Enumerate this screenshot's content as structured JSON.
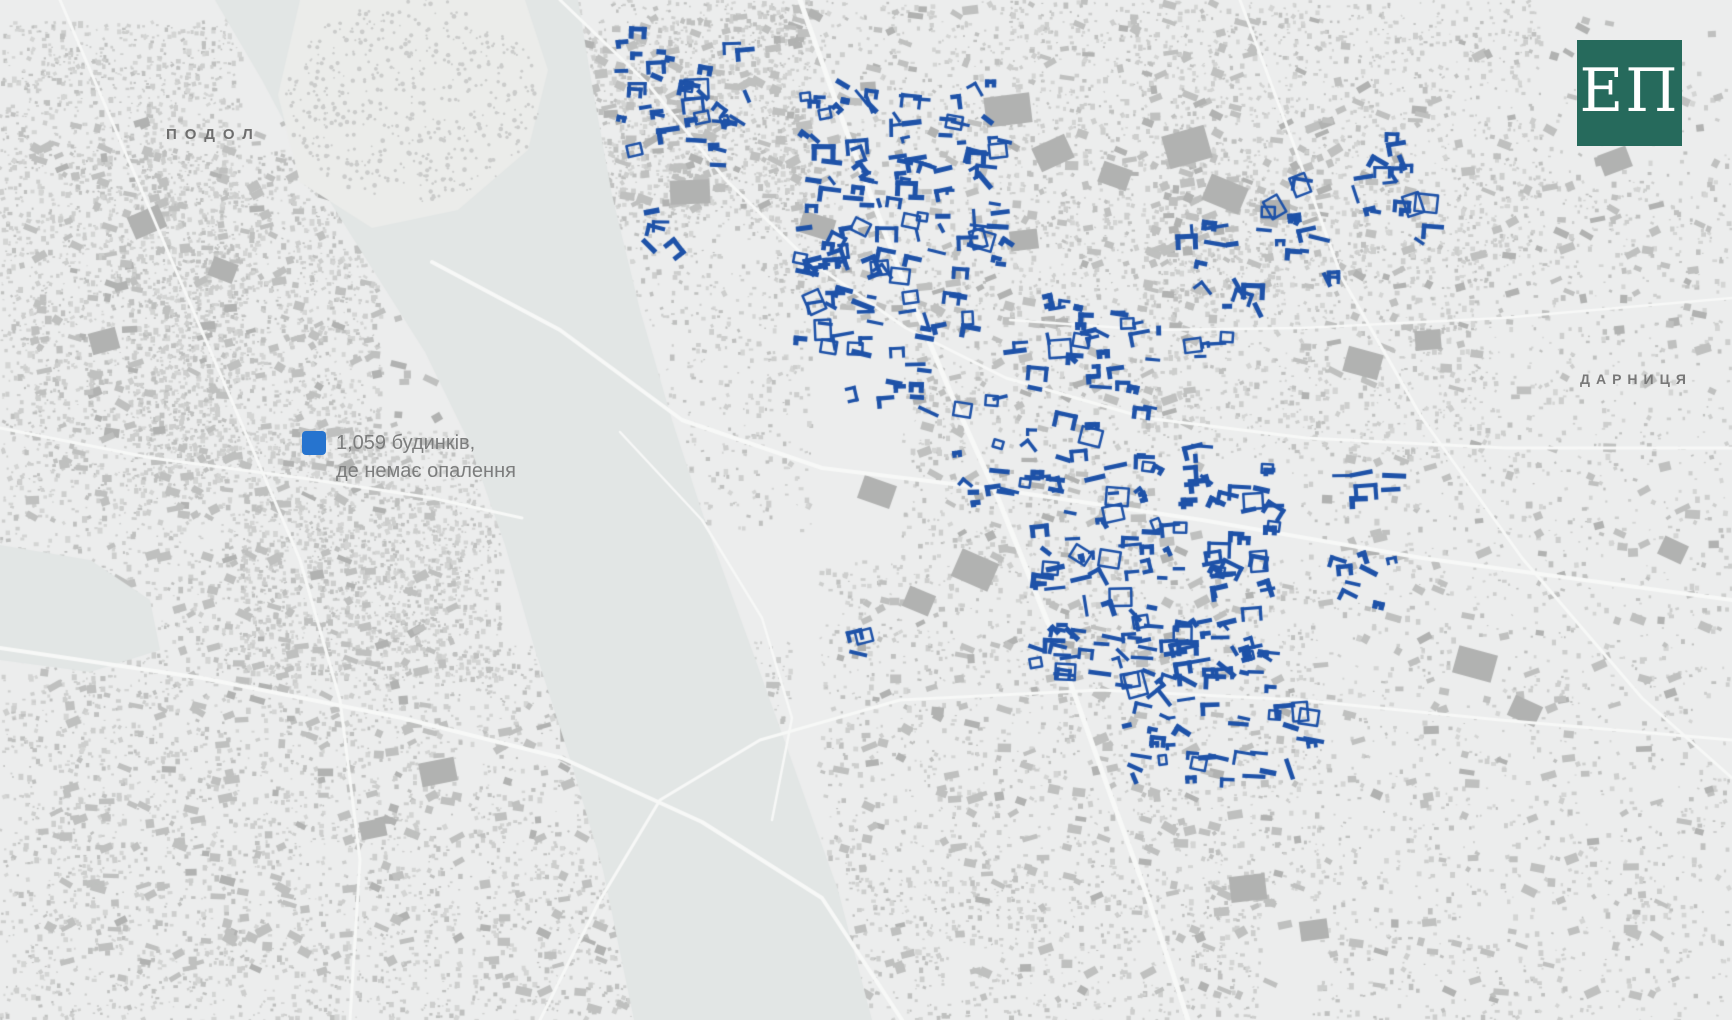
{
  "labels": {
    "podol": "ПОДОЛ",
    "darnytsia": "ДАРНИЦЯ"
  },
  "legend": {
    "line1": "1,059 будинків,",
    "line2": "де немає опалення",
    "swatch_color": "#2674cf",
    "text_color": "#7c7d7d"
  },
  "logo": {
    "text": "ЕП",
    "bg_color": "#266a5c",
    "text_color": "#ffffff"
  },
  "colors": {
    "land": "#eceded",
    "island_land": "#ebecea",
    "water": "#e2e6e5",
    "road": "#f7f8f7",
    "building_light": "#cdcecd",
    "building_mid": "#bfc0bf",
    "building_dark": "#b1b2b1",
    "tree": "#cbcccb",
    "highlight_blue": "#1e52a8"
  },
  "map_render": {
    "seed": 1337,
    "speckle_regions": [
      {
        "x": 0,
        "y": 20,
        "w": 240,
        "h": 480,
        "n": 2300
      },
      {
        "x": 130,
        "y": 150,
        "w": 250,
        "h": 330,
        "n": 1700
      },
      {
        "x": 240,
        "y": 430,
        "w": 260,
        "h": 250,
        "n": 1300
      },
      {
        "x": 0,
        "y": 500,
        "w": 460,
        "h": 520,
        "n": 3200
      },
      {
        "x": 540,
        "y": 0,
        "w": 270,
        "h": 230,
        "n": 1500
      },
      {
        "x": 610,
        "y": 230,
        "w": 200,
        "h": 300,
        "n": 480
      },
      {
        "x": 760,
        "y": 0,
        "w": 260,
        "h": 320,
        "n": 800
      },
      {
        "x": 1010,
        "y": 0,
        "w": 280,
        "h": 300,
        "n": 1200
      },
      {
        "x": 1290,
        "y": 0,
        "w": 250,
        "h": 260,
        "n": 800
      },
      {
        "x": 1540,
        "y": 60,
        "w": 190,
        "h": 210,
        "n": 140
      },
      {
        "x": 1140,
        "y": 240,
        "w": 350,
        "h": 220,
        "n": 900
      },
      {
        "x": 900,
        "y": 300,
        "w": 260,
        "h": 280,
        "n": 700
      },
      {
        "x": 820,
        "y": 560,
        "w": 500,
        "h": 330,
        "n": 1500
      },
      {
        "x": 760,
        "y": 880,
        "w": 500,
        "h": 140,
        "n": 800
      },
      {
        "x": 470,
        "y": 640,
        "w": 320,
        "h": 380,
        "n": 1500
      },
      {
        "x": 1290,
        "y": 420,
        "w": 440,
        "h": 360,
        "n": 850
      },
      {
        "x": 1310,
        "y": 780,
        "w": 420,
        "h": 240,
        "n": 650
      },
      {
        "x": 1430,
        "y": 180,
        "w": 300,
        "h": 240,
        "n": 420
      }
    ],
    "medium_regions": [
      {
        "x": 30,
        "y": 120,
        "w": 420,
        "h": 400,
        "n": 260
      },
      {
        "x": 40,
        "y": 540,
        "w": 420,
        "h": 440,
        "n": 240
      },
      {
        "x": 560,
        "y": 10,
        "w": 240,
        "h": 200,
        "n": 120
      },
      {
        "x": 790,
        "y": 0,
        "w": 480,
        "h": 330,
        "n": 180
      },
      {
        "x": 900,
        "y": 320,
        "w": 300,
        "h": 240,
        "n": 90
      },
      {
        "x": 840,
        "y": 580,
        "w": 460,
        "h": 420,
        "n": 200
      },
      {
        "x": 1300,
        "y": 20,
        "w": 420,
        "h": 380,
        "n": 130
      },
      {
        "x": 1320,
        "y": 440,
        "w": 400,
        "h": 560,
        "n": 150
      },
      {
        "x": 480,
        "y": 660,
        "w": 300,
        "h": 350,
        "n": 130
      },
      {
        "x": 1150,
        "y": 120,
        "w": 180,
        "h": 140,
        "n": 70
      }
    ],
    "blocks": [
      {
        "x": 670,
        "y": 180,
        "w": 40,
        "h": 24
      },
      {
        "x": 800,
        "y": 215,
        "w": 34,
        "h": 22
      },
      {
        "x": 985,
        "y": 95,
        "w": 46,
        "h": 30
      },
      {
        "x": 1035,
        "y": 140,
        "w": 36,
        "h": 26
      },
      {
        "x": 1100,
        "y": 165,
        "w": 30,
        "h": 22
      },
      {
        "x": 1010,
        "y": 230,
        "w": 28,
        "h": 20
      },
      {
        "x": 1165,
        "y": 130,
        "w": 44,
        "h": 34
      },
      {
        "x": 1205,
        "y": 180,
        "w": 40,
        "h": 28
      },
      {
        "x": 1260,
        "y": 200,
        "w": 30,
        "h": 20
      },
      {
        "x": 1345,
        "y": 350,
        "w": 36,
        "h": 26
      },
      {
        "x": 1415,
        "y": 330,
        "w": 26,
        "h": 20
      },
      {
        "x": 955,
        "y": 555,
        "w": 40,
        "h": 30
      },
      {
        "x": 905,
        "y": 590,
        "w": 28,
        "h": 22
      },
      {
        "x": 760,
        "y": 850,
        "w": 44,
        "h": 30
      },
      {
        "x": 700,
        "y": 800,
        "w": 30,
        "h": 22
      },
      {
        "x": 560,
        "y": 715,
        "w": 36,
        "h": 26
      },
      {
        "x": 615,
        "y": 760,
        "w": 26,
        "h": 20
      },
      {
        "x": 1455,
        "y": 650,
        "w": 40,
        "h": 28
      },
      {
        "x": 1510,
        "y": 700,
        "w": 30,
        "h": 22
      },
      {
        "x": 1230,
        "y": 875,
        "w": 36,
        "h": 26
      },
      {
        "x": 1300,
        "y": 920,
        "w": 28,
        "h": 20
      },
      {
        "x": 130,
        "y": 210,
        "w": 34,
        "h": 24
      },
      {
        "x": 210,
        "y": 260,
        "w": 26,
        "h": 20
      },
      {
        "x": 320,
        "y": 180,
        "w": 30,
        "h": 22
      },
      {
        "x": 90,
        "y": 330,
        "w": 28,
        "h": 22
      },
      {
        "x": 420,
        "y": 760,
        "w": 36,
        "h": 24
      },
      {
        "x": 360,
        "y": 820,
        "w": 26,
        "h": 18
      },
      {
        "x": 1600,
        "y": 150,
        "w": 30,
        "h": 22
      },
      {
        "x": 1660,
        "y": 540,
        "w": 26,
        "h": 20
      },
      {
        "x": 860,
        "y": 480,
        "w": 34,
        "h": 24
      }
    ],
    "water_main": [
      [
        215,
        0
      ],
      [
        262,
        80
      ],
      [
        310,
        170
      ],
      [
        368,
        262
      ],
      [
        425,
        352
      ],
      [
        468,
        440
      ],
      [
        505,
        545
      ],
      [
        535,
        650
      ],
      [
        572,
        765
      ],
      [
        603,
        870
      ],
      [
        634,
        1020
      ],
      [
        872,
        1020
      ],
      [
        838,
        890
      ],
      [
        795,
        770
      ],
      [
        752,
        650
      ],
      [
        708,
        530
      ],
      [
        672,
        420
      ],
      [
        640,
        310
      ],
      [
        612,
        195
      ],
      [
        592,
        85
      ],
      [
        578,
        0
      ]
    ],
    "water_bay": [
      [
        0,
        545
      ],
      [
        90,
        560
      ],
      [
        150,
        600
      ],
      [
        160,
        650
      ],
      [
        90,
        672
      ],
      [
        0,
        660
      ]
    ],
    "island": {
      "poly": [
        [
          300,
          0
        ],
        [
          525,
          0
        ],
        [
          548,
          70
        ],
        [
          528,
          150
        ],
        [
          458,
          210
        ],
        [
          372,
          228
        ],
        [
          300,
          182
        ],
        [
          278,
          95
        ]
      ],
      "cx": 413,
      "cy": 100,
      "rx": 128,
      "ry": 102,
      "trees": 520
    },
    "roads": [
      {
        "w": 5,
        "pts": [
          [
            800,
            0
          ],
          [
            846,
            130
          ],
          [
            900,
            272
          ],
          [
            952,
            396
          ],
          [
            998,
            498
          ],
          [
            1058,
            648
          ],
          [
            1108,
            788
          ],
          [
            1148,
            898
          ],
          [
            1188,
            1020
          ]
        ]
      },
      {
        "w": 4,
        "pts": [
          [
            432,
            262
          ],
          [
            560,
            330
          ],
          [
            682,
            420
          ],
          [
            822,
            468
          ],
          [
            1002,
            490
          ],
          [
            1202,
            520
          ],
          [
            1422,
            558
          ],
          [
            1732,
            600
          ]
        ]
      },
      {
        "w": 3,
        "pts": [
          [
            560,
            0
          ],
          [
            648,
            84
          ],
          [
            726,
            180
          ],
          [
            806,
            258
          ],
          [
            906,
            328
          ],
          [
            1006,
            378
          ],
          [
            1146,
            418
          ],
          [
            1306,
            438
          ],
          [
            1506,
            448
          ],
          [
            1732,
            448
          ]
        ]
      },
      {
        "w": 4,
        "pts": [
          [
            0,
            648
          ],
          [
            202,
            678
          ],
          [
            402,
            718
          ],
          [
            562,
            758
          ],
          [
            702,
            822
          ],
          [
            822,
            898
          ],
          [
            902,
            1020
          ]
        ]
      },
      {
        "w": 3,
        "pts": [
          [
            1240,
            0
          ],
          [
            1292,
            140
          ],
          [
            1342,
            278
          ],
          [
            1422,
            418
          ],
          [
            1522,
            558
          ],
          [
            1642,
            698
          ],
          [
            1732,
            778
          ]
        ]
      },
      {
        "w": 3,
        "pts": [
          [
            0,
            428
          ],
          [
            152,
            458
          ],
          [
            302,
            478
          ],
          [
            432,
            498
          ],
          [
            522,
            518
          ]
        ]
      },
      {
        "w": 2.5,
        "pts": [
          [
            620,
            432
          ],
          [
            702,
            520
          ],
          [
            762,
            618
          ],
          [
            792,
            718
          ],
          [
            772,
            820
          ]
        ]
      },
      {
        "w": 2.5,
        "pts": [
          [
            1732,
            298
          ],
          [
            1502,
            318
          ],
          [
            1302,
            328
          ],
          [
            1152,
            330
          ],
          [
            1010,
            320
          ]
        ]
      },
      {
        "w": 3,
        "pts": [
          [
            60,
            0
          ],
          [
            120,
            140
          ],
          [
            180,
            280
          ],
          [
            240,
            420
          ],
          [
            300,
            560
          ],
          [
            340,
            700
          ],
          [
            360,
            860
          ],
          [
            350,
            1020
          ]
        ]
      },
      {
        "w": 3,
        "pts": [
          [
            540,
            1020
          ],
          [
            600,
            900
          ],
          [
            660,
            800
          ],
          [
            760,
            740
          ],
          [
            900,
            700
          ],
          [
            1100,
            690
          ],
          [
            1300,
            700
          ],
          [
            1500,
            720
          ],
          [
            1732,
            740
          ]
        ]
      }
    ],
    "blue_clusters": [
      {
        "name": "north-left",
        "x": 618,
        "y": 30,
        "w": 130,
        "h": 140,
        "n": 38,
        "rot": 0
      },
      {
        "name": "north-straggler",
        "x": 648,
        "y": 195,
        "w": 28,
        "h": 55,
        "n": 5,
        "rot": 0
      },
      {
        "name": "center-core",
        "x": 792,
        "y": 82,
        "w": 218,
        "h": 265,
        "n": 135,
        "rot": 0
      },
      {
        "name": "center-band-se",
        "x": 935,
        "y": 330,
        "w": 210,
        "h": 150,
        "n": 40,
        "rot": -28
      },
      {
        "name": "center-west-bits",
        "x": 845,
        "y": 345,
        "w": 90,
        "h": 60,
        "n": 10,
        "rot": 0
      },
      {
        "name": "center-east",
        "x": 1010,
        "y": 300,
        "w": 120,
        "h": 90,
        "n": 14,
        "rot": 0
      },
      {
        "name": "east-band",
        "x": 1190,
        "y": 165,
        "w": 250,
        "h": 130,
        "n": 48,
        "rot": -24
      },
      {
        "name": "east-bits",
        "x": 1130,
        "y": 320,
        "w": 90,
        "h": 40,
        "n": 8,
        "rot": 0
      },
      {
        "name": "southeast-core",
        "x": 1035,
        "y": 445,
        "w": 240,
        "h": 230,
        "n": 130,
        "rot": 0
      },
      {
        "name": "southeast-south",
        "x": 1120,
        "y": 620,
        "w": 170,
        "h": 160,
        "n": 55,
        "rot": 0
      },
      {
        "name": "southeast-east",
        "x": 1335,
        "y": 470,
        "w": 70,
        "h": 140,
        "n": 14,
        "rot": 0
      },
      {
        "name": "southeast-tip",
        "x": 1270,
        "y": 710,
        "w": 50,
        "h": 40,
        "n": 7,
        "rot": 0
      },
      {
        "name": "single-west",
        "x": 845,
        "y": 630,
        "w": 20,
        "h": 30,
        "n": 3,
        "rot": 0
      }
    ]
  }
}
